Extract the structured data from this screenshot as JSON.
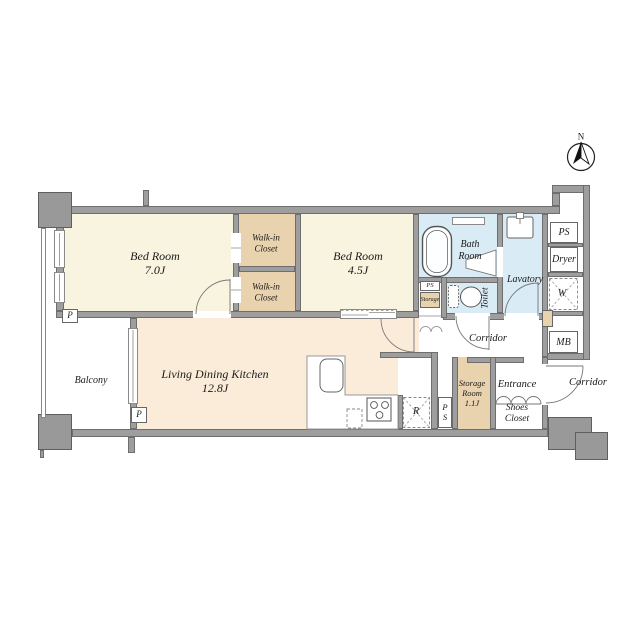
{
  "compass": {
    "label": "N"
  },
  "rooms": {
    "bedroom_main": {
      "name": "Bed Room",
      "size": "7.0J"
    },
    "bedroom_second": {
      "name": "Bed Room",
      "size": "4.5J"
    },
    "walkin_closet_upper": {
      "line1": "Walk-in",
      "line2": "Closet"
    },
    "walkin_closet_lower": {
      "line1": "Walk-in",
      "line2": "Closet"
    },
    "living_dining_kitchen": {
      "name": "Living Dining Kitchen",
      "size": "12.8J"
    },
    "bath_room": {
      "line1": "Bath",
      "line2": "Room"
    },
    "lavatory": {
      "name": "Lavatory"
    },
    "toilet": {
      "name": "Toilet"
    },
    "corridor_inner": {
      "name": "Corridor"
    },
    "corridor_outer": {
      "name": "Corridor"
    },
    "entrance": {
      "name": "Entrance"
    },
    "shoes_closet": {
      "line1": "Shoes",
      "line2": "Closet"
    },
    "storage_room": {
      "line1": "Storage",
      "line2": "Room",
      "size": "1.1J"
    },
    "storage_closet": {
      "name": "Storage"
    },
    "balcony": {
      "name": "Balcony"
    }
  },
  "fixtures": {
    "ps_upper": "PS",
    "ps_mid": "PS",
    "ps_kitchen_p": "P",
    "ps_kitchen_s": "S",
    "dryer": "Dryer",
    "washing_machine": "W",
    "refrigerator": "R",
    "meter_box": "MB",
    "pipe_shaft_left": "P",
    "pipe_shaft_mid": "P"
  },
  "colors": {
    "wall": "#9e9e9e",
    "bedroom": "#f9f4df",
    "closet": "#e9d3ae",
    "living": "#faecd9",
    "wet_area": "#d9ebf4",
    "background": "#ffffff"
  }
}
